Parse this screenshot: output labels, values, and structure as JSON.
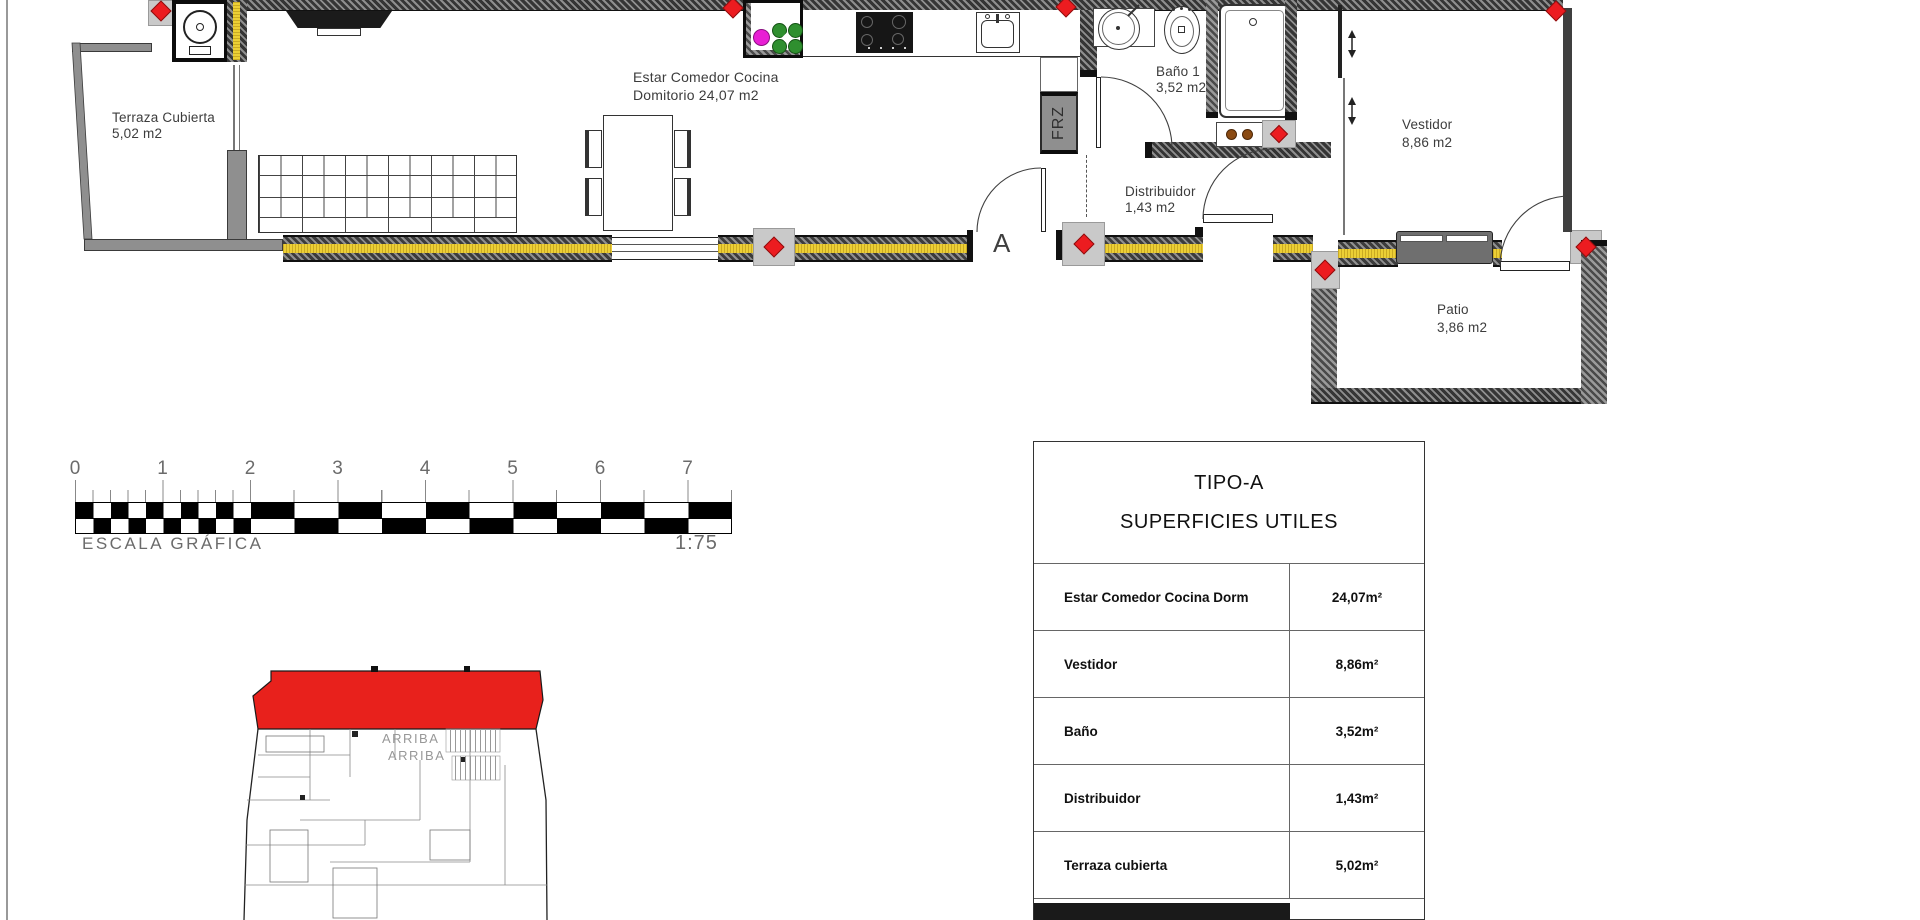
{
  "drawing": {
    "rooms": {
      "terraza": {
        "line1": "Terraza Cubierta",
        "line2": "5,02 m2"
      },
      "estar": {
        "line1": "Estar Comedor Cocina",
        "line2": "Domitorio 24,07 m2"
      },
      "bano": {
        "line1": "Baño 1",
        "line2": "3,52 m2"
      },
      "distribuidor": {
        "line1": "Distribuidor",
        "line2": "1,43 m2"
      },
      "vestidor": {
        "line1": "Vestidor",
        "line2": "8,86 m2"
      },
      "patio": {
        "line1": "Patio",
        "line2": "3,86 m2"
      }
    },
    "annotations": {
      "freezer": "FRZ",
      "entrance_marker": "A"
    }
  },
  "scale_bar": {
    "numbers": [
      "0",
      "1",
      "2",
      "3",
      "4",
      "5",
      "6",
      "7"
    ],
    "title": "ESCALA GRÁFICA",
    "ratio": "1:75"
  },
  "key_plan": {
    "stairs_label_1": "ARRIBA",
    "stairs_label_2": "ARRIBA",
    "highlight_color": "#e8211c"
  },
  "summary_table": {
    "title": "TIPO-A",
    "subtitle": "SUPERFICIES UTILES",
    "rows": [
      {
        "label": "Estar Comedor Cocina Dorm",
        "value": "24,07m²"
      },
      {
        "label": "Vestidor",
        "value": "8,86m²"
      },
      {
        "label": "Baño",
        "value": "3,52m²"
      },
      {
        "label": "Distribuidor",
        "value": "1,43m²"
      },
      {
        "label": "Terraza cubierta",
        "value": "5,02m²"
      }
    ]
  },
  "colors": {
    "highlight_red": "#e8211c",
    "marker_red": "#ec1c20",
    "insulation_yellow": "#eccf35",
    "wall_dark": "#3a3a3a"
  }
}
